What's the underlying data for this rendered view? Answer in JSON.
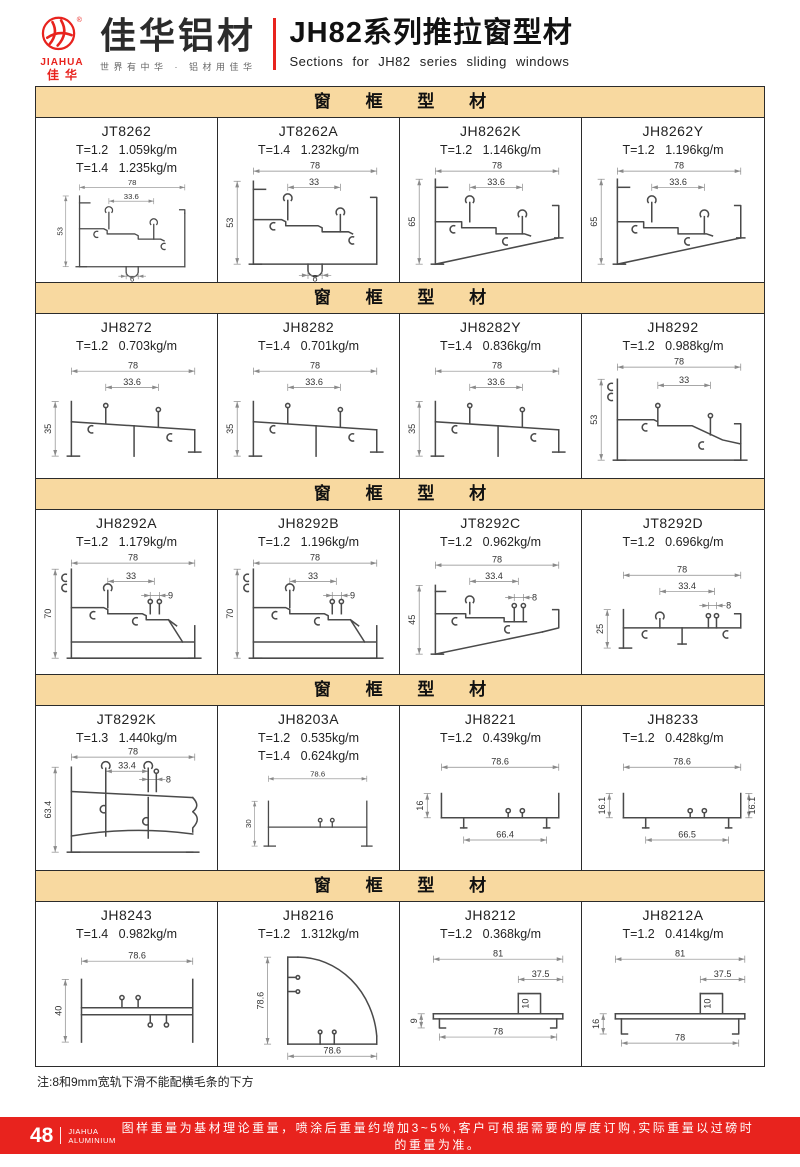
{
  "header": {
    "brand_en": "JIAHUA",
    "brand_cn": "佳华",
    "logo_cn": "佳华铝材",
    "slogan": "世界有中华 · 铝材用佳华",
    "title_cn": "JH82系列推拉窗型材",
    "title_en": "Sections for JH82 series sliding windows"
  },
  "colors": {
    "accent_red": "#e8231e",
    "section_header_bg": "#f8d9a0",
    "table_border": "#2b2b2b"
  },
  "sections": [
    {
      "title": "窗 框 型 材",
      "cells": [
        {
          "code": "JT8262",
          "specs": [
            "T=1.2   1.059kg/m",
            "T=1.4   1.235kg/m"
          ],
          "drawing": {
            "type": "step",
            "w": "78",
            "inner": "33.6",
            "h": "53",
            "bottom": "6"
          }
        },
        {
          "code": "JT8262A",
          "specs": [
            "T=1.4   1.232kg/m"
          ],
          "drawing": {
            "type": "step",
            "w": "78",
            "inner": "33",
            "h": "53",
            "bottom": "8"
          }
        },
        {
          "code": "JH8262K",
          "specs": [
            "T=1.2   1.146kg/m"
          ],
          "drawing": {
            "type": "stepSlant",
            "w": "78",
            "inner": "33.6",
            "h": "65"
          }
        },
        {
          "code": "JH8262Y",
          "specs": [
            "T=1.2   1.196kg/m"
          ],
          "drawing": {
            "type": "stepSlant",
            "w": "78",
            "inner": "33.6",
            "h": "65"
          }
        }
      ]
    },
    {
      "title": "窗 框 型 材",
      "cells": [
        {
          "code": "JH8272",
          "specs": [
            "T=1.2   0.703kg/m"
          ],
          "drawing": {
            "type": "low",
            "w": "78",
            "inner": "33.6",
            "h": "35"
          }
        },
        {
          "code": "JH8282",
          "specs": [
            "T=1.4   0.701kg/m"
          ],
          "drawing": {
            "type": "low",
            "w": "78",
            "inner": "33.6",
            "h": "35"
          }
        },
        {
          "code": "JH8282Y",
          "specs": [
            "T=1.4   0.836kg/m"
          ],
          "drawing": {
            "type": "low",
            "w": "78",
            "inner": "33.6",
            "h": "35"
          }
        },
        {
          "code": "JH8292",
          "specs": [
            "T=1.2   0.988kg/m"
          ],
          "drawing": {
            "type": "step53",
            "w": "78",
            "inner": "33",
            "h": "53"
          }
        }
      ]
    },
    {
      "title": "窗 框 型 材",
      "cells": [
        {
          "code": "JH8292A",
          "specs": [
            "T=1.2   1.179kg/m"
          ],
          "drawing": {
            "type": "tall70",
            "w": "78",
            "inner": "33",
            "sub": "9",
            "h": "70"
          }
        },
        {
          "code": "JH8292B",
          "specs": [
            "T=1.2   1.196kg/m"
          ],
          "drawing": {
            "type": "tall70",
            "w": "78",
            "inner": "33",
            "sub": "9",
            "h": "70"
          }
        },
        {
          "code": "JT8292C",
          "specs": [
            "T=1.2   0.962kg/m"
          ],
          "drawing": {
            "type": "step45",
            "w": "78",
            "inner": "33.4",
            "sub": "8",
            "h": "45"
          }
        },
        {
          "code": "JT8292D",
          "specs": [
            "T=1.2   0.696kg/m"
          ],
          "drawing": {
            "type": "flat25",
            "w": "78",
            "inner": "33.4",
            "sub": "8",
            "h": "25"
          }
        }
      ]
    },
    {
      "title": "窗 框 型 材",
      "cells": [
        {
          "code": "JT8292K",
          "specs": [
            "T=1.3   1.440kg/m"
          ],
          "drawing": {
            "type": "boxK",
            "w": "78",
            "inner": "33.4",
            "sub": "8",
            "h": "63.4"
          }
        },
        {
          "code": "JH8203A",
          "specs": [
            "T=1.2   0.535kg/m",
            "T=1.4   0.624kg/m"
          ],
          "drawing": {
            "type": "tray30",
            "w": "78.6",
            "h": "30"
          }
        },
        {
          "code": "JH8221",
          "specs": [
            "T=1.2   0.439kg/m"
          ],
          "drawing": {
            "type": "tray16",
            "w": "78.6",
            "h": "16",
            "bottom": "66.4"
          }
        },
        {
          "code": "JH8233",
          "specs": [
            "T=1.2   0.428kg/m"
          ],
          "drawing": {
            "type": "tray161",
            "w": "78.6",
            "h": "16.1",
            "h2": "16.1",
            "bottom": "66.5"
          }
        }
      ]
    },
    {
      "title": "窗 框 型 材",
      "cells": [
        {
          "code": "JH8243",
          "specs": [
            "T=1.4   0.982kg/m"
          ],
          "drawing": {
            "type": "tray40",
            "w": "78.6",
            "h": "40"
          }
        },
        {
          "code": "JH8216",
          "specs": [
            "T=1.2   1.312kg/m"
          ],
          "drawing": {
            "type": "quarter",
            "v": "78.6",
            "b": "78.6"
          }
        },
        {
          "code": "JH8212",
          "specs": [
            "T=1.2   0.368kg/m"
          ],
          "drawing": {
            "type": "flatbar",
            "w": "81",
            "inner": "37.5",
            "sub": "10",
            "h": "9",
            "bottom": "78"
          }
        },
        {
          "code": "JH8212A",
          "specs": [
            "T=1.2   0.414kg/m"
          ],
          "drawing": {
            "type": "flatbar",
            "w": "81",
            "inner": "37.5",
            "sub": "10",
            "h": "16",
            "bottom": "78"
          }
        }
      ]
    }
  ],
  "note": "注:8和9mm宽轨下滑不能配横毛条的下方",
  "footer": {
    "page": "48",
    "brand_line1": "JIAHUA",
    "brand_line2": "ALUMINIUM",
    "text": "图样重量为基材理论重量，喷涂后重量约增加3~5%,客户可根据需要的厚度订购,实际重量以过磅时的重量为准。"
  }
}
